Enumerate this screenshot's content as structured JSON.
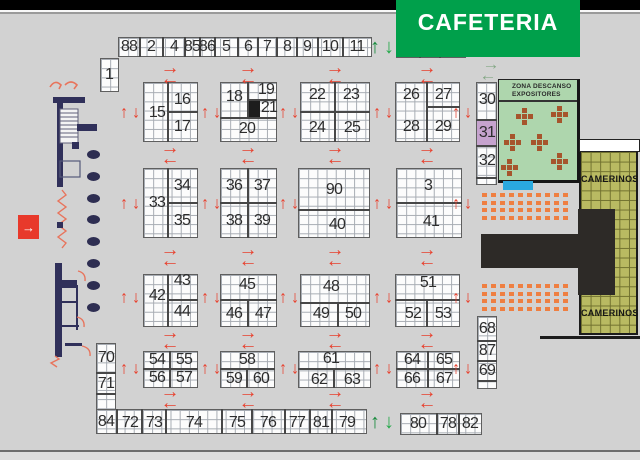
{
  "areas": {
    "cafeteria": {
      "label": "CAFETERIA",
      "fill": "#00a04b",
      "text_color": "#ffffff"
    },
    "zona_descanso": {
      "line1": "ZONA DESCANSO",
      "line2": "EXPOSITORES",
      "fill": "#aed6ad"
    },
    "camerinos": {
      "label": "CAMERINOS",
      "fill": "#b9ba62"
    },
    "entrance": {
      "symbol": "→",
      "fill": "#e8392b"
    }
  },
  "colors": {
    "floor": "#d2d2d2",
    "arrow_red": "#e8402d",
    "arrow_green_up": "#178a3c",
    "arrow_green_down": "#25a94a",
    "arrow_pale": "#84a886",
    "booth_highlight_purple": "#c6a3ce",
    "black_cell": "#1d1d1d",
    "pool_blue": "#2aa9df",
    "seat_orange": "#ef7f41",
    "table_brown": "#a6552c",
    "stage_black": "#2d2a27",
    "wall_navy": "#30305a"
  },
  "plan": {
    "grids": [
      {
        "n": "top-strip-left",
        "x": 118,
        "y": 37,
        "w": 254,
        "h": 20
      },
      {
        "n": "top-strip-right",
        "x": 396,
        "y": 38,
        "w": 70,
        "h": 20
      },
      {
        "n": "booth-1-block",
        "x": 100,
        "y": 58,
        "w": 19,
        "h": 34
      },
      {
        "n": "block-15-17",
        "x": 143,
        "y": 82,
        "w": 55,
        "h": 60
      },
      {
        "n": "block-18-21",
        "x": 220,
        "y": 82,
        "w": 57,
        "h": 60
      },
      {
        "n": "block-22-25",
        "x": 300,
        "y": 82,
        "w": 70,
        "h": 60
      },
      {
        "n": "block-26-29",
        "x": 395,
        "y": 82,
        "w": 65,
        "h": 60
      },
      {
        "n": "strip-30-32",
        "x": 476,
        "y": 82,
        "w": 21,
        "h": 103
      },
      {
        "n": "block-33-35",
        "x": 143,
        "y": 168,
        "w": 55,
        "h": 70
      },
      {
        "n": "block-36-39",
        "x": 220,
        "y": 168,
        "w": 57,
        "h": 70
      },
      {
        "n": "block-90-40",
        "x": 298,
        "y": 168,
        "w": 72,
        "h": 70
      },
      {
        "n": "block-3-41",
        "x": 396,
        "y": 168,
        "w": 66,
        "h": 70
      },
      {
        "n": "block-42-44",
        "x": 143,
        "y": 274,
        "w": 55,
        "h": 53
      },
      {
        "n": "block-45-47",
        "x": 220,
        "y": 274,
        "w": 57,
        "h": 53
      },
      {
        "n": "block-48-50",
        "x": 300,
        "y": 274,
        "w": 70,
        "h": 53
      },
      {
        "n": "block-51-53",
        "x": 395,
        "y": 274,
        "w": 65,
        "h": 53
      },
      {
        "n": "block-54-57",
        "x": 143,
        "y": 351,
        "w": 55,
        "h": 37
      },
      {
        "n": "block-58-60",
        "x": 220,
        "y": 351,
        "w": 55,
        "h": 37
      },
      {
        "n": "block-61-63",
        "x": 298,
        "y": 351,
        "w": 73,
        "h": 37
      },
      {
        "n": "block-64-67",
        "x": 396,
        "y": 351,
        "w": 64,
        "h": 37
      },
      {
        "n": "strip-70-71",
        "x": 96,
        "y": 343,
        "w": 20,
        "h": 67
      },
      {
        "n": "bottom-strip-left",
        "x": 96,
        "y": 409,
        "w": 271,
        "h": 25
      },
      {
        "n": "bottom-strip-right",
        "x": 400,
        "y": 413,
        "w": 82,
        "h": 22
      },
      {
        "n": "strip-68-87-69",
        "x": 477,
        "y": 316,
        "w": 20,
        "h": 73
      }
    ],
    "overlays": [
      {
        "n": "booth-block-filled-cell",
        "x": 248,
        "y": 100,
        "w": 12,
        "h": 18,
        "fill": "#1d1d1d"
      },
      {
        "n": "booth-31-highlight",
        "x": 477,
        "y": 120,
        "w": 19,
        "h": 26,
        "fill": "#c6a3ce"
      },
      {
        "n": "pool-blue-marker",
        "x": 503,
        "y": 181,
        "w": 30,
        "h": 9,
        "fill": "#2aa9df"
      },
      {
        "n": "camerinos-corridor",
        "x": 579,
        "y": 139,
        "w": 59,
        "h": 11,
        "fill": "#ffffff",
        "border": "1px solid #222"
      }
    ],
    "dividers": [
      [
        140,
        37,
        140,
        57
      ],
      [
        163,
        37,
        163,
        57
      ],
      [
        185,
        37,
        185,
        57
      ],
      [
        200,
        37,
        200,
        57
      ],
      [
        215,
        37,
        215,
        57
      ],
      [
        238,
        37,
        238,
        57
      ],
      [
        258,
        37,
        258,
        57
      ],
      [
        277,
        37,
        277,
        57
      ],
      [
        297,
        37,
        297,
        57
      ],
      [
        318,
        37,
        318,
        57
      ],
      [
        343,
        37,
        343,
        57
      ],
      [
        420,
        38,
        420,
        58
      ],
      [
        440,
        38,
        440,
        58
      ],
      [
        117,
        409,
        117,
        434
      ],
      [
        142,
        409,
        142,
        434
      ],
      [
        166,
        409,
        166,
        434
      ],
      [
        222,
        409,
        222,
        434
      ],
      [
        252,
        409,
        252,
        434
      ],
      [
        285,
        409,
        285,
        434
      ],
      [
        310,
        409,
        310,
        434
      ],
      [
        332,
        409,
        332,
        434
      ],
      [
        437,
        413,
        437,
        435
      ],
      [
        459,
        413,
        459,
        435
      ],
      [
        96,
        373,
        116,
        373
      ],
      [
        96,
        394,
        116,
        394
      ],
      [
        476,
        120,
        497,
        120
      ],
      [
        476,
        146,
        497,
        146
      ],
      [
        476,
        178,
        497,
        178
      ],
      [
        477,
        341,
        497,
        341
      ],
      [
        477,
        361,
        497,
        361
      ],
      [
        477,
        381,
        497,
        381
      ],
      [
        168,
        82,
        168,
        142
      ],
      [
        168,
        112,
        198,
        112
      ],
      [
        248,
        82,
        248,
        118
      ],
      [
        248,
        100,
        277,
        100
      ],
      [
        220,
        118,
        277,
        118
      ],
      [
        335,
        82,
        335,
        142
      ],
      [
        300,
        112,
        370,
        112
      ],
      [
        427,
        82,
        427,
        142
      ],
      [
        427,
        107,
        460,
        107
      ],
      [
        168,
        168,
        168,
        238
      ],
      [
        168,
        203,
        198,
        203
      ],
      [
        248,
        168,
        248,
        238
      ],
      [
        220,
        203,
        277,
        203
      ],
      [
        298,
        210,
        370,
        210
      ],
      [
        396,
        203,
        462,
        203
      ],
      [
        168,
        274,
        168,
        327
      ],
      [
        168,
        300,
        198,
        300
      ],
      [
        220,
        300,
        277,
        300
      ],
      [
        248,
        300,
        248,
        327
      ],
      [
        300,
        303,
        370,
        303
      ],
      [
        338,
        303,
        338,
        327
      ],
      [
        395,
        300,
        460,
        300
      ],
      [
        427,
        300,
        427,
        327
      ],
      [
        170,
        351,
        170,
        388
      ],
      [
        143,
        369,
        198,
        369
      ],
      [
        220,
        369,
        275,
        369
      ],
      [
        247,
        369,
        247,
        388
      ],
      [
        298,
        369,
        371,
        369
      ],
      [
        334,
        369,
        334,
        388
      ],
      [
        428,
        351,
        428,
        388
      ],
      [
        396,
        369,
        460,
        369
      ]
    ],
    "booth_labels": [
      [
        "1",
        109,
        75
      ],
      [
        "88",
        129,
        47
      ],
      [
        "2",
        151,
        47
      ],
      [
        "4",
        174,
        47
      ],
      [
        "85",
        192,
        47
      ],
      [
        "86",
        207,
        47
      ],
      [
        "5",
        226,
        47
      ],
      [
        "6",
        248,
        47
      ],
      [
        "7",
        267,
        47
      ],
      [
        "8",
        287,
        47
      ],
      [
        "9",
        307,
        47
      ],
      [
        "10",
        330,
        47
      ],
      [
        "11",
        357,
        47
      ],
      [
        "12",
        408,
        48
      ],
      [
        "13",
        430,
        48
      ],
      [
        "14",
        452,
        48
      ],
      [
        "15",
        157,
        113
      ],
      [
        "16",
        182,
        100
      ],
      [
        "17",
        182,
        127
      ],
      [
        "18",
        234,
        97
      ],
      [
        "19",
        266,
        90
      ],
      [
        "21",
        269,
        108
      ],
      [
        "20",
        247,
        129
      ],
      [
        "22",
        317,
        95
      ],
      [
        "23",
        351,
        95
      ],
      [
        "24",
        317,
        128
      ],
      [
        "25",
        352,
        128
      ],
      [
        "26",
        411,
        95
      ],
      [
        "27",
        443,
        95
      ],
      [
        "28",
        411,
        127
      ],
      [
        "29",
        443,
        127
      ],
      [
        "30",
        487,
        100
      ],
      [
        "31",
        487,
        133
      ],
      [
        "32",
        487,
        161
      ],
      [
        "33",
        157,
        203
      ],
      [
        "34",
        182,
        186
      ],
      [
        "35",
        182,
        221
      ],
      [
        "36",
        234,
        186
      ],
      [
        "37",
        262,
        186
      ],
      [
        "38",
        234,
        221
      ],
      [
        "39",
        262,
        221
      ],
      [
        "90",
        334,
        190
      ],
      [
        "40",
        337,
        225
      ],
      [
        "3",
        428,
        186
      ],
      [
        "41",
        431,
        222
      ],
      [
        "42",
        157,
        296
      ],
      [
        "43",
        182,
        281
      ],
      [
        "44",
        182,
        312
      ],
      [
        "45",
        247,
        285
      ],
      [
        "46",
        234,
        314
      ],
      [
        "47",
        263,
        314
      ],
      [
        "48",
        331,
        287
      ],
      [
        "49",
        321,
        314
      ],
      [
        "50",
        353,
        314
      ],
      [
        "51",
        428,
        283
      ],
      [
        "52",
        413,
        314
      ],
      [
        "53",
        443,
        314
      ],
      [
        "54",
        157,
        360
      ],
      [
        "55",
        184,
        360
      ],
      [
        "56",
        157,
        378
      ],
      [
        "57",
        184,
        378
      ],
      [
        "58",
        247,
        360
      ],
      [
        "59",
        234,
        379
      ],
      [
        "60",
        261,
        379
      ],
      [
        "61",
        331,
        359
      ],
      [
        "62",
        319,
        380
      ],
      [
        "63",
        352,
        380
      ],
      [
        "64",
        412,
        360
      ],
      [
        "65",
        444,
        360
      ],
      [
        "66",
        412,
        379
      ],
      [
        "67",
        444,
        379
      ],
      [
        "68",
        487,
        329
      ],
      [
        "87",
        487,
        351
      ],
      [
        "69",
        487,
        371
      ],
      [
        "70",
        106,
        358
      ],
      [
        "71",
        106,
        384
      ],
      [
        "84",
        106,
        422
      ],
      [
        "72",
        130,
        423
      ],
      [
        "73",
        154,
        423
      ],
      [
        "74",
        194,
        423
      ],
      [
        "75",
        237,
        423
      ],
      [
        "76",
        268,
        423
      ],
      [
        "77",
        297,
        423
      ],
      [
        "81",
        321,
        423
      ],
      [
        "79",
        347,
        423
      ],
      [
        "80",
        418,
        424
      ],
      [
        "78",
        448,
        424
      ],
      [
        "82",
        470,
        424
      ]
    ],
    "arrows": {
      "h_cols": [
        170,
        248,
        335,
        427
      ],
      "h_rows": [
        73,
        153,
        255,
        338,
        397
      ],
      "v_cols": [
        130,
        211,
        289,
        383,
        462
      ],
      "v_rows": [
        112,
        203,
        297,
        368
      ],
      "green_pairs": [
        [
          382,
          47
        ],
        [
          382,
          422
        ]
      ],
      "pale": [
        {
          "g": "→",
          "x": 491,
          "y": 64
        },
        {
          "g": "←",
          "x": 488,
          "y": 75
        }
      ]
    },
    "seating": {
      "origins": [
        [
          482,
          193
        ],
        [
          482,
          284
        ]
      ],
      "cols": 10,
      "rows": 4,
      "dx": 9,
      "dy": 7.5
    },
    "tables": [
      [
        524,
        116
      ],
      [
        559,
        114
      ],
      [
        512,
        142
      ],
      [
        539,
        142
      ],
      [
        559,
        161
      ],
      [
        509,
        167
      ]
    ],
    "ovals": {
      "x": 87,
      "ys": [
        150,
        172,
        194,
        215,
        237,
        259,
        281,
        303
      ]
    }
  }
}
